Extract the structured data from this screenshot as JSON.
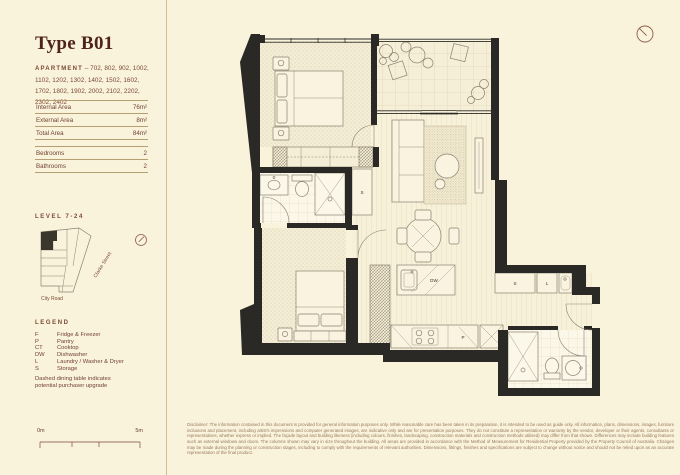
{
  "colors": {
    "background": "#faf3dc",
    "title_brown": "#4f231a",
    "text_brown": "#7a4a36",
    "wall_dark": "#2b2925",
    "plan_line": "#8b8170",
    "rule": "#b79d72"
  },
  "sidebar": {
    "title": "Type B01",
    "apartment_label": "APARTMENT",
    "apartment_numbers": "– 702, 802, 902, 1002, 1102, 1202, 1302, 1402, 1502, 1602, 1702, 1802, 1902, 2002, 2102, 2202, 2302, 2402",
    "areas": [
      {
        "label": "Internal Area",
        "value": "76m²"
      },
      {
        "label": "External Area",
        "value": "8m²"
      },
      {
        "label": "Total Area",
        "value": "84m²"
      }
    ],
    "rooms": [
      {
        "label": "Bedrooms",
        "value": "2"
      },
      {
        "label": "Bathrooms",
        "value": "2"
      }
    ],
    "level_label": "LEVEL 7-24",
    "keyplan": {
      "street_label": "Clarke Street",
      "road_label": "City Road"
    },
    "legend": {
      "heading": "LEGEND",
      "items": [
        {
          "abbr": "F",
          "label": "Fridge & Freezer"
        },
        {
          "abbr": "P",
          "label": "Pantry"
        },
        {
          "abbr": "CT",
          "label": "Cooktop"
        },
        {
          "abbr": "DW",
          "label": "Dishwasher"
        },
        {
          "abbr": "L",
          "label": "Laundry / Washer & Dryer"
        },
        {
          "abbr": "S",
          "label": "Storage"
        }
      ],
      "note": "Dashed dining table indicates potential purchaser upgrade"
    },
    "scalebar": {
      "start": "0m",
      "end": "5m"
    }
  },
  "plan": {
    "labels": {
      "dishwasher": "DW",
      "pantry": "P",
      "storage": "S",
      "laundry": "L"
    }
  },
  "footer": {
    "disclaimer": "Disclaimer: The information contained in this document is provided for general information purposes only. While reasonable care has been taken in its preparation, it is intended to be used as guide only. All information, plans, dimensions, images, furniture inclusions and placement, including artist's impressions and computer generated images, are indicative only and are for presentation purposes. They do not constitute a representation or warranty by the vendor, developer or their agents, consultants or representatives, whether express or implied. The façade layout and building likeness (including colours, finishes, landscaping, construction materials and construction methods utilised) may differ from that shown. Differences may include building features such as external windows and doors. The columns shown may vary in size throughout the building. All areas are provided in accordance with the Method of Measurement for Residential Property provided by the Property Council of Australia. Changes may be made during the planning or construction stages, including to comply with the requirements of relevant authorities. Dimensions, fittings, finishes and specifications are subject to change without notice and should not be relied upon as an accurate representation of the final product."
  }
}
